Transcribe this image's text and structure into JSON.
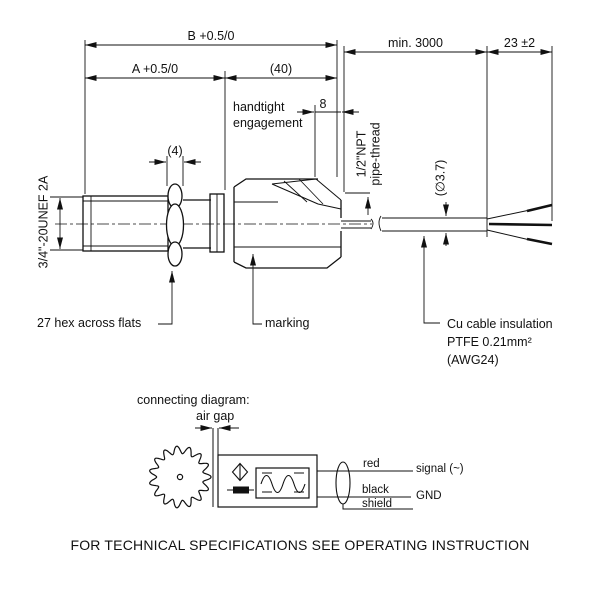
{
  "colors": {
    "line": "#111111",
    "background": "#ffffff",
    "text": "#111111"
  },
  "main_drawing": {
    "dim_b": "B +0.5/0",
    "dim_a": "A +0.5/0",
    "dim_40": "(40)",
    "dim_min3000": "min. 3000",
    "dim_23": "23 ±2",
    "dim_8": "8",
    "dim_4": "(4)",
    "thread_spec": "3/4\"-20UNEF 2A",
    "pipe_thread": "1/2\"NPT\npipe-thread",
    "cable_dia": "(∅3.7)",
    "handtight": "handtight\nengagement",
    "hex_label": "27 hex across flats",
    "marking_label": "marking",
    "cable_label": "Cu cable insulation\nPTFE 0.21mm²\n(AWG24)"
  },
  "connecting_diagram": {
    "title": "connecting diagram:",
    "air_gap": "air gap",
    "wire_red": "red",
    "wire_black": "black",
    "wire_shield": "shield",
    "out_signal": "signal (~)",
    "out_gnd": "GND"
  },
  "footer": "FOR TECHNICAL SPECIFICATIONS SEE OPERATING INSTRUCTION"
}
